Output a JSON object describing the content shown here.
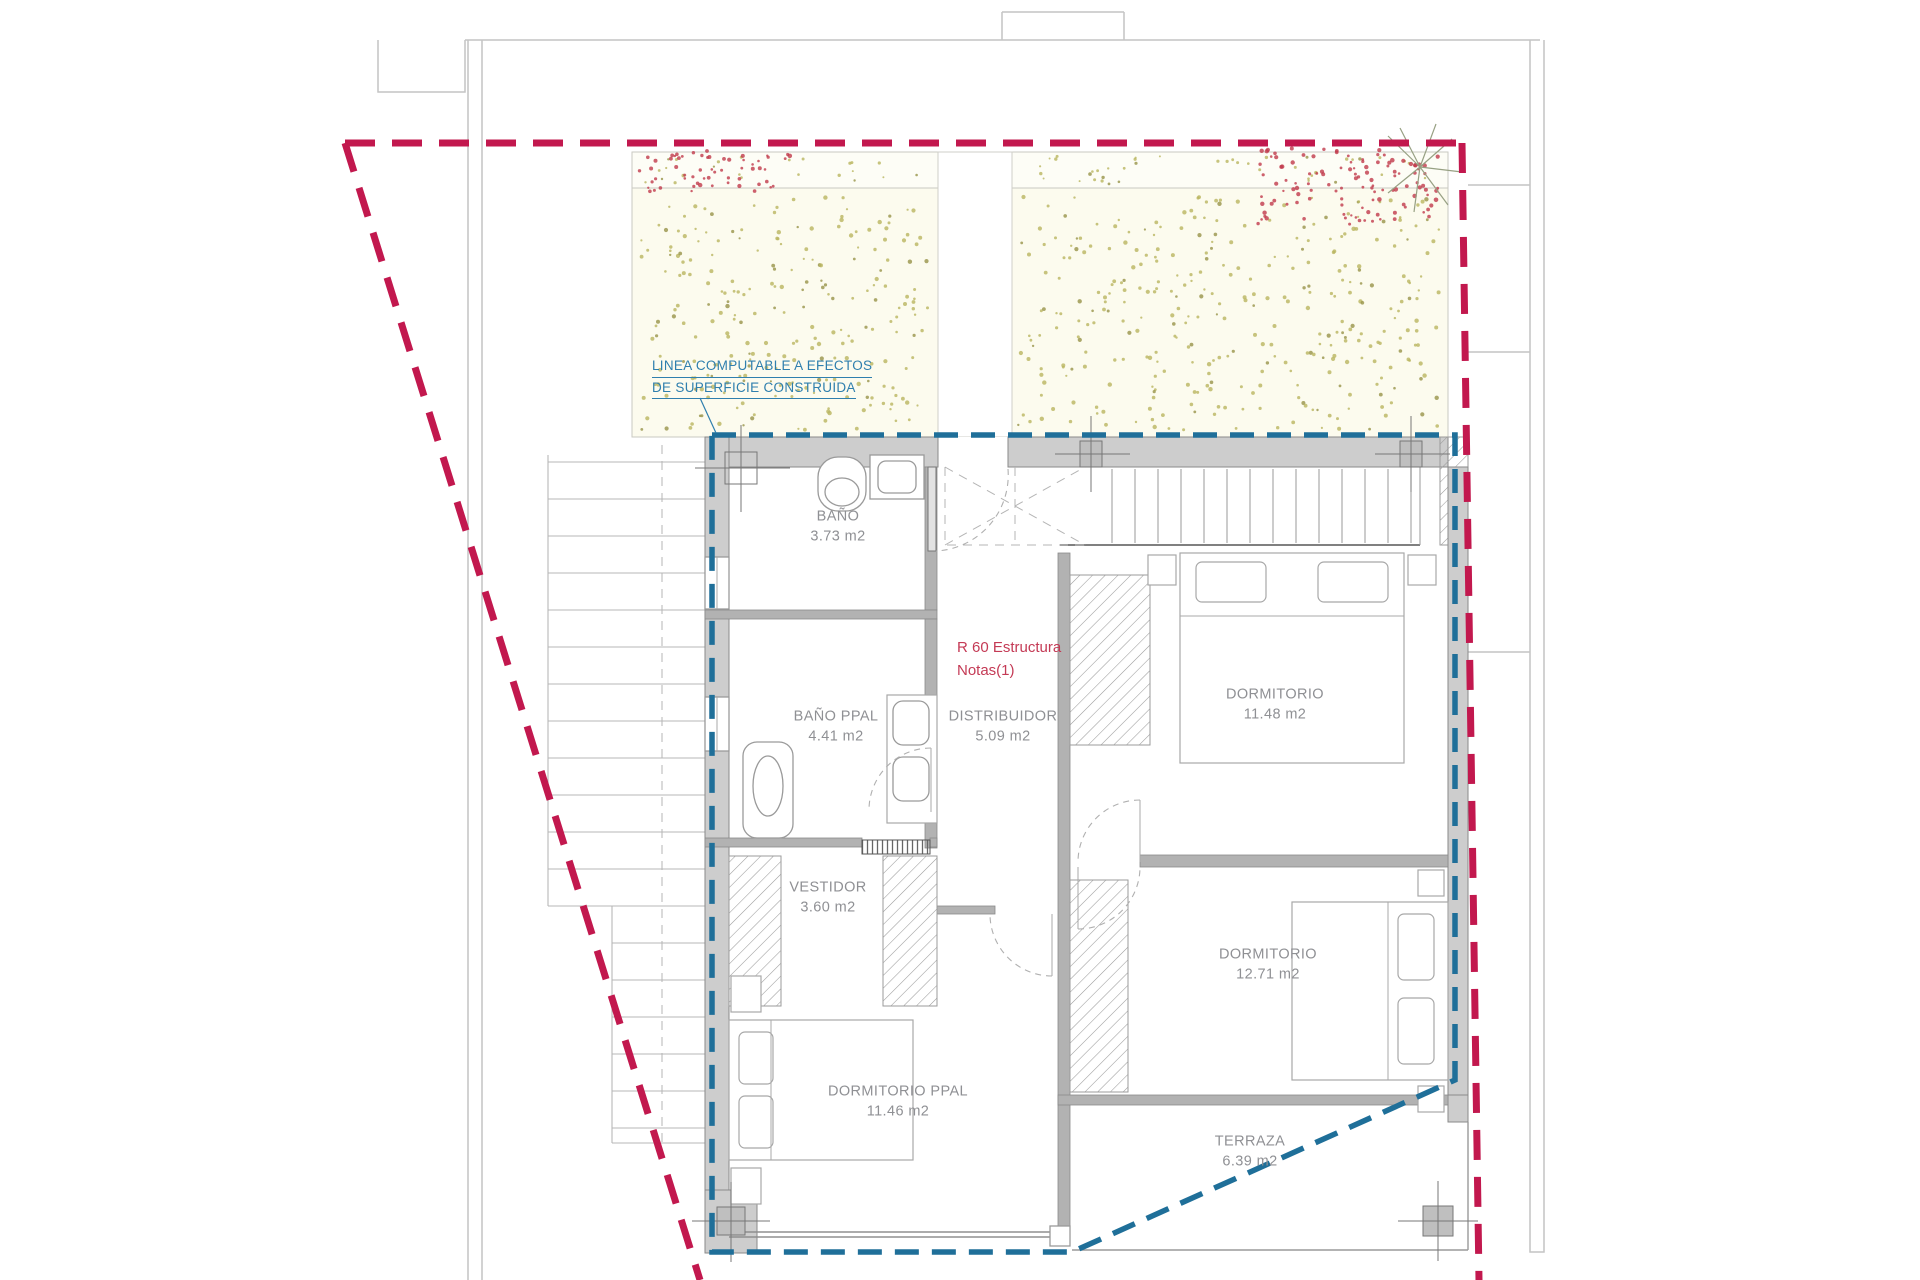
{
  "drawing": {
    "notes": {
      "computable_line": {
        "line1": "LINEA COMPUTABLE A EFECTOS",
        "line2": "DE SUPERFICIE CONSTRUIDA"
      },
      "structure_note": {
        "line1": "R 60 Estructura",
        "line2": "Notas(1)"
      }
    },
    "rooms": [
      {
        "id": "bano",
        "name": "BAÑO",
        "area": "3.73 m2"
      },
      {
        "id": "bano-ppal",
        "name": "BAÑO PPAL",
        "area": "4.41 m2"
      },
      {
        "id": "distribuidor",
        "name": "DISTRIBUIDOR",
        "area": "5.09 m2"
      },
      {
        "id": "dormitorio-1",
        "name": "DORMITORIO",
        "area": "11.48 m2"
      },
      {
        "id": "vestidor",
        "name": "VESTIDOR",
        "area": "3.60 m2"
      },
      {
        "id": "dormitorio-2",
        "name": "DORMITORIO",
        "area": "12.71 m2"
      },
      {
        "id": "dormitorio-ppal",
        "name": "DORMITORIO PPAL",
        "area": "11.46 m2"
      },
      {
        "id": "terraza",
        "name": "TERRAZA",
        "area": "6.39 m2"
      }
    ],
    "colors": {
      "parcel_boundary": "#c2184e",
      "computable_boundary": "#1f6f99",
      "wall_fill": "#cdcdcd",
      "wall_inner": "#b2b2b2",
      "garden_dot": "#b9b55f",
      "flower_dot": "#c0394b",
      "label_text": "#8f9094",
      "blue_text": "#2f7fae",
      "red_text": "#c43a55"
    }
  }
}
